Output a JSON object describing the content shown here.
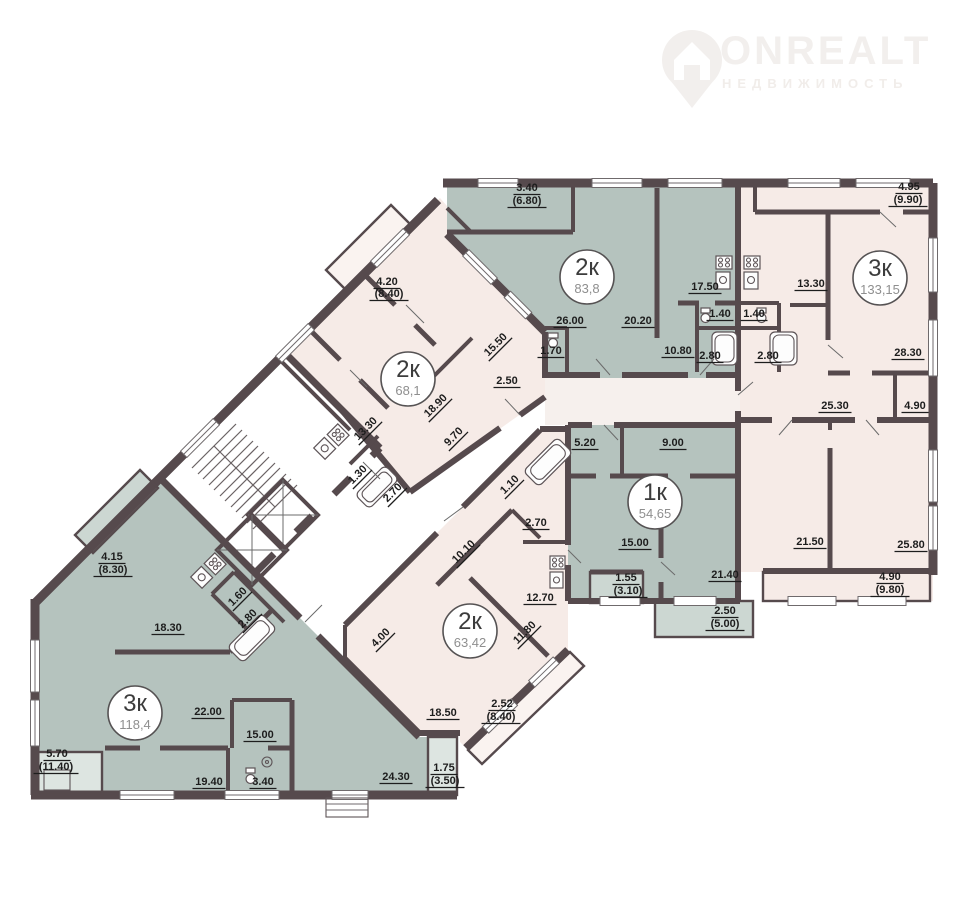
{
  "watermark": {
    "brand": "ONREALT",
    "tagline": "НЕДВИЖИМОСТЬ"
  },
  "palette": {
    "wall": "#564a4d",
    "sage": "#b5c3be",
    "sage_light": "#ccd7d2",
    "pink": "#f6ebe7",
    "pink_light": "#faf3f0",
    "corridor": "#f6f0ed",
    "label": "#1d1d1d",
    "badge_area_text": "#8f8f8f",
    "background": "#ffffff"
  },
  "apartments": [
    {
      "id": "apt-2k-83",
      "type": "2к",
      "area": "83,8",
      "badge": {
        "x": 587,
        "y": 277
      },
      "rooms": [
        {
          "t": "3.40",
          "x": 527,
          "y": 191
        },
        {
          "t": "(6.80)",
          "x": 527,
          "y": 204
        },
        {
          "t": "26.00",
          "x": 570,
          "y": 324
        },
        {
          "t": "20.20",
          "x": 638,
          "y": 324
        },
        {
          "t": "17.50",
          "x": 705,
          "y": 290
        },
        {
          "t": "1.40",
          "x": 720,
          "y": 317
        },
        {
          "t": "2.80",
          "x": 710,
          "y": 359
        },
        {
          "t": "10.80",
          "x": 678,
          "y": 354
        },
        {
          "t": "1.70",
          "x": 551,
          "y": 354
        }
      ]
    },
    {
      "id": "apt-3k-133",
      "type": "3к",
      "area": "133,15",
      "badge": {
        "x": 880,
        "y": 278
      },
      "rooms": [
        {
          "t": "4.95",
          "x": 909,
          "y": 190
        },
        {
          "t": "(9.90)",
          "x": 908,
          "y": 203
        },
        {
          "t": "13.30",
          "x": 811,
          "y": 287
        },
        {
          "t": "28.30",
          "x": 908,
          "y": 356
        },
        {
          "t": "1.40",
          "x": 754,
          "y": 317
        },
        {
          "t": "2.80",
          "x": 768,
          "y": 359
        },
        {
          "t": "25.30",
          "x": 835,
          "y": 409
        },
        {
          "t": "4.90",
          "x": 915,
          "y": 409
        },
        {
          "t": "21.50",
          "x": 810,
          "y": 545
        },
        {
          "t": "25.80",
          "x": 911,
          "y": 548
        },
        {
          "t": "4.90",
          "x": 890,
          "y": 580
        },
        {
          "t": "(9.80)",
          "x": 890,
          "y": 593
        }
      ]
    },
    {
      "id": "apt-2k-68",
      "type": "2к",
      "area": "68,1",
      "badge": {
        "x": 408,
        "y": 379
      },
      "rooms": [
        {
          "t": "4.20",
          "x": 387,
          "y": 285
        },
        {
          "t": "(8.40)",
          "x": 389,
          "y": 297
        },
        {
          "t": "15.50",
          "x": 498,
          "y": 347,
          "r": -45
        },
        {
          "t": "2.50",
          "x": 507,
          "y": 384
        },
        {
          "t": "18.90",
          "x": 438,
          "y": 408,
          "r": -45
        },
        {
          "t": "9.70",
          "x": 456,
          "y": 439,
          "r": -45
        },
        {
          "t": "13.30",
          "x": 368,
          "y": 431,
          "r": -45
        },
        {
          "t": "1.30",
          "x": 360,
          "y": 477,
          "r": -45
        },
        {
          "t": "2.70",
          "x": 395,
          "y": 495,
          "r": -45
        }
      ]
    },
    {
      "id": "apt-1k-54",
      "type": "1к",
      "area": "54,65",
      "badge": {
        "x": 655,
        "y": 502
      },
      "rooms": [
        {
          "t": "5.20",
          "x": 585,
          "y": 446
        },
        {
          "t": "9.00",
          "x": 673,
          "y": 446
        },
        {
          "t": "15.00",
          "x": 635,
          "y": 546
        },
        {
          "t": "21.40",
          "x": 725,
          "y": 578
        },
        {
          "t": "1.55",
          "x": 626,
          "y": 581
        },
        {
          "t": "(3.10)",
          "x": 628,
          "y": 594
        },
        {
          "t": "2.50",
          "x": 725,
          "y": 614
        },
        {
          "t": "(5.00)",
          "x": 725,
          "y": 627
        }
      ]
    },
    {
      "id": "apt-2k-63",
      "type": "2к",
      "area": "63,42",
      "badge": {
        "x": 470,
        "y": 631
      },
      "rooms": [
        {
          "t": "1.10",
          "x": 512,
          "y": 487,
          "r": -45
        },
        {
          "t": "2.70",
          "x": 536,
          "y": 526
        },
        {
          "t": "10.10",
          "x": 466,
          "y": 554,
          "r": -45
        },
        {
          "t": "12.70",
          "x": 540,
          "y": 601
        },
        {
          "t": "11.80",
          "x": 527,
          "y": 635,
          "r": -45
        },
        {
          "t": "4.00",
          "x": 383,
          "y": 640,
          "r": -45
        },
        {
          "t": "18.50",
          "x": 443,
          "y": 716
        },
        {
          "t": "2.52",
          "x": 502,
          "y": 707
        },
        {
          "t": "(8.40)",
          "x": 501,
          "y": 720
        }
      ]
    },
    {
      "id": "apt-3k-118",
      "type": "3к",
      "area": "118,4",
      "badge": {
        "x": 135,
        "y": 713
      },
      "rooms": [
        {
          "t": "4.15",
          "x": 112,
          "y": 560
        },
        {
          "t": "(8.30)",
          "x": 113,
          "y": 573
        },
        {
          "t": "18.30",
          "x": 168,
          "y": 631
        },
        {
          "t": "1.60",
          "x": 240,
          "y": 599,
          "r": -45
        },
        {
          "t": "2.80",
          "x": 250,
          "y": 621,
          "r": -45
        },
        {
          "t": "22.00",
          "x": 208,
          "y": 715
        },
        {
          "t": "15.00",
          "x": 260,
          "y": 738
        },
        {
          "t": "19.40",
          "x": 209,
          "y": 785
        },
        {
          "t": "3.40",
          "x": 263,
          "y": 785
        },
        {
          "t": "24.30",
          "x": 396,
          "y": 780
        },
        {
          "t": "5.70",
          "x": 57,
          "y": 757
        },
        {
          "t": "(11.40)",
          "x": 56,
          "y": 770
        },
        {
          "t": "1.75",
          "x": 444,
          "y": 771
        },
        {
          "t": "(3.50)",
          "x": 445,
          "y": 784
        }
      ]
    }
  ]
}
